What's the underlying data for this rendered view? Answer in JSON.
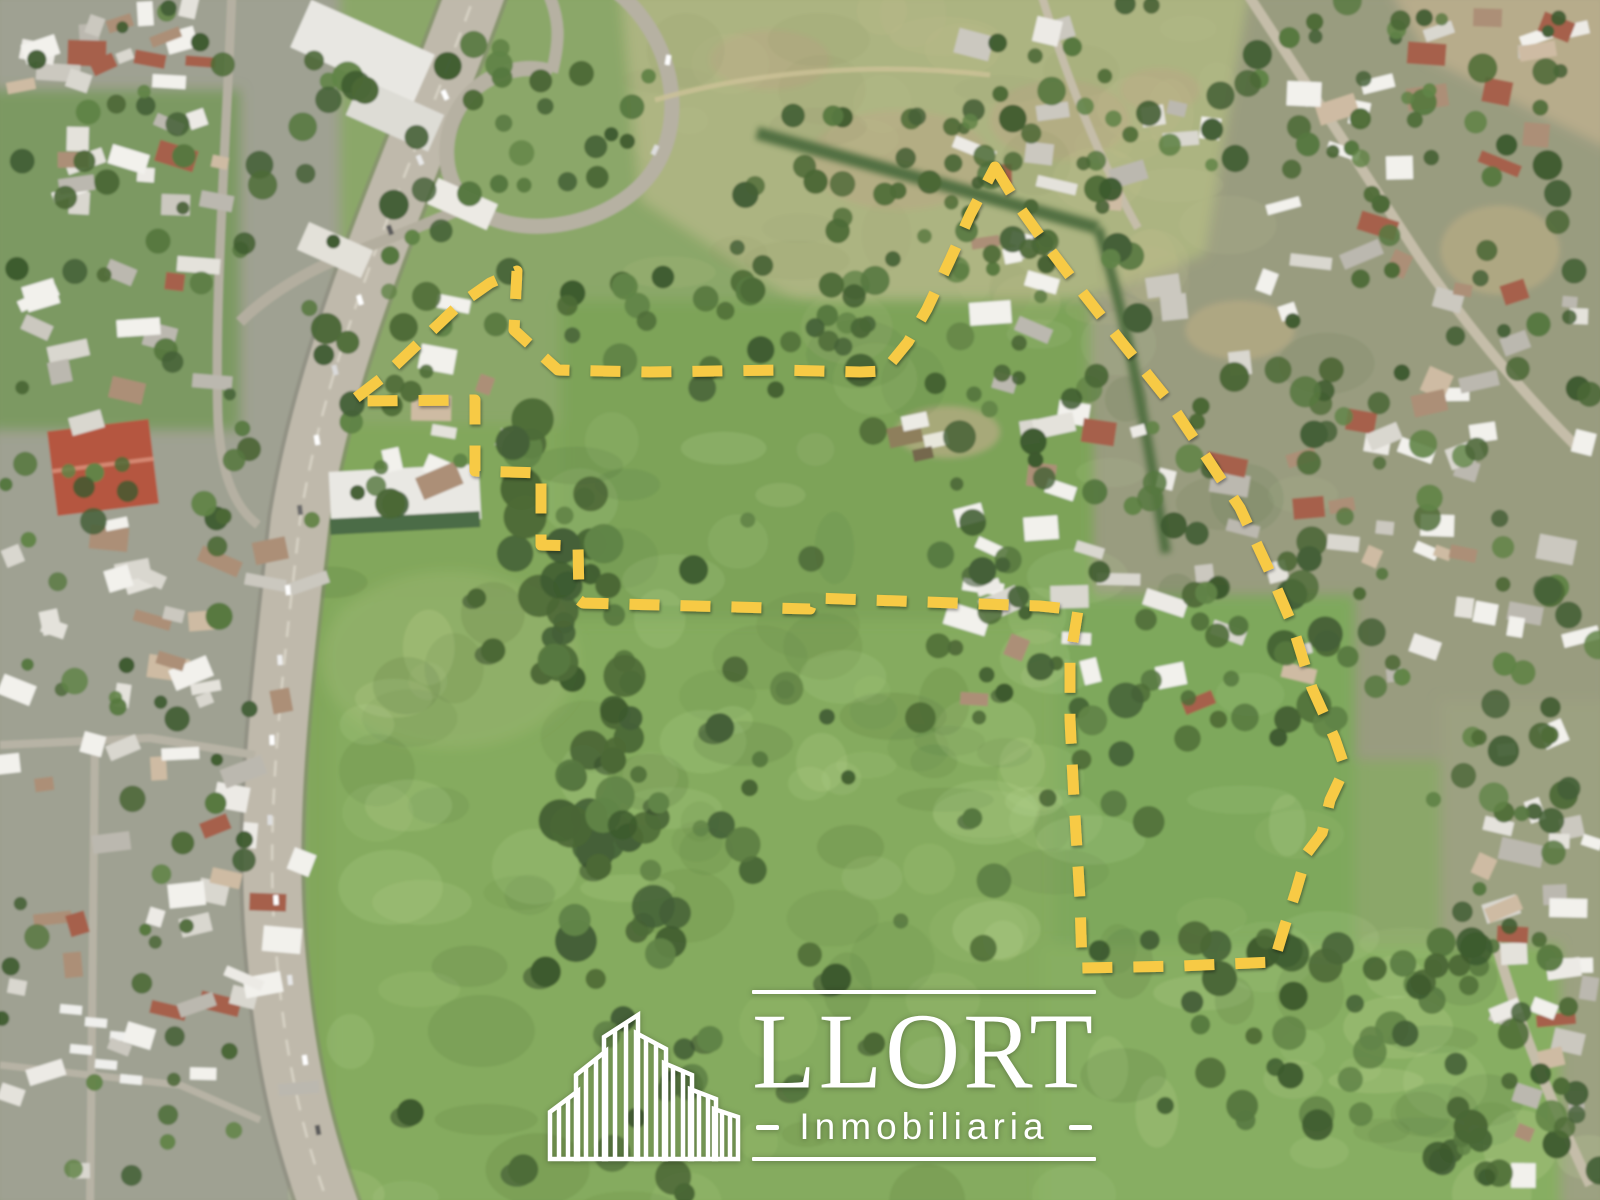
{
  "watermark": {
    "brand": "LLORT",
    "tagline": "Inmobiliaria",
    "color": "#ffffff"
  },
  "boundary": {
    "color": "#F7CA45",
    "style": "dashed",
    "dash_length_px": 30,
    "gap_px": 21,
    "stroke_width_px": 11,
    "points": [
      [
        995,
        167
      ],
      [
        1020,
        208
      ],
      [
        1048,
        247
      ],
      [
        1083,
        293
      ],
      [
        1120,
        340
      ],
      [
        1168,
        400
      ],
      [
        1205,
        455
      ],
      [
        1240,
        508
      ],
      [
        1268,
        568
      ],
      [
        1292,
        624
      ],
      [
        1312,
        688
      ],
      [
        1335,
        739
      ],
      [
        1345,
        768
      ],
      [
        1330,
        800
      ],
      [
        1322,
        833
      ],
      [
        1307,
        853
      ],
      [
        1296,
        891
      ],
      [
        1285,
        925
      ],
      [
        1274,
        962
      ],
      [
        1180,
        966
      ],
      [
        1082,
        968
      ],
      [
        1080,
        900
      ],
      [
        1074,
        800
      ],
      [
        1070,
        720
      ],
      [
        1070,
        660
      ],
      [
        1078,
        610
      ],
      [
        1040,
        606
      ],
      [
        814,
        598
      ],
      [
        810,
        609
      ],
      [
        583,
        603
      ],
      [
        579,
        600
      ],
      [
        578,
        546
      ],
      [
        541,
        545
      ],
      [
        541,
        473
      ],
      [
        475,
        471
      ],
      [
        475,
        400
      ],
      [
        352,
        401
      ],
      [
        383,
        377
      ],
      [
        421,
        341
      ],
      [
        460,
        304
      ],
      [
        490,
        283
      ],
      [
        517,
        271
      ],
      [
        514,
        330
      ],
      [
        558,
        370
      ],
      [
        650,
        372
      ],
      [
        780,
        370
      ],
      [
        860,
        372
      ],
      [
        884,
        371
      ],
      [
        890,
        364
      ],
      [
        908,
        342
      ],
      [
        927,
        309
      ],
      [
        950,
        260
      ],
      [
        970,
        215
      ]
    ]
  }
}
